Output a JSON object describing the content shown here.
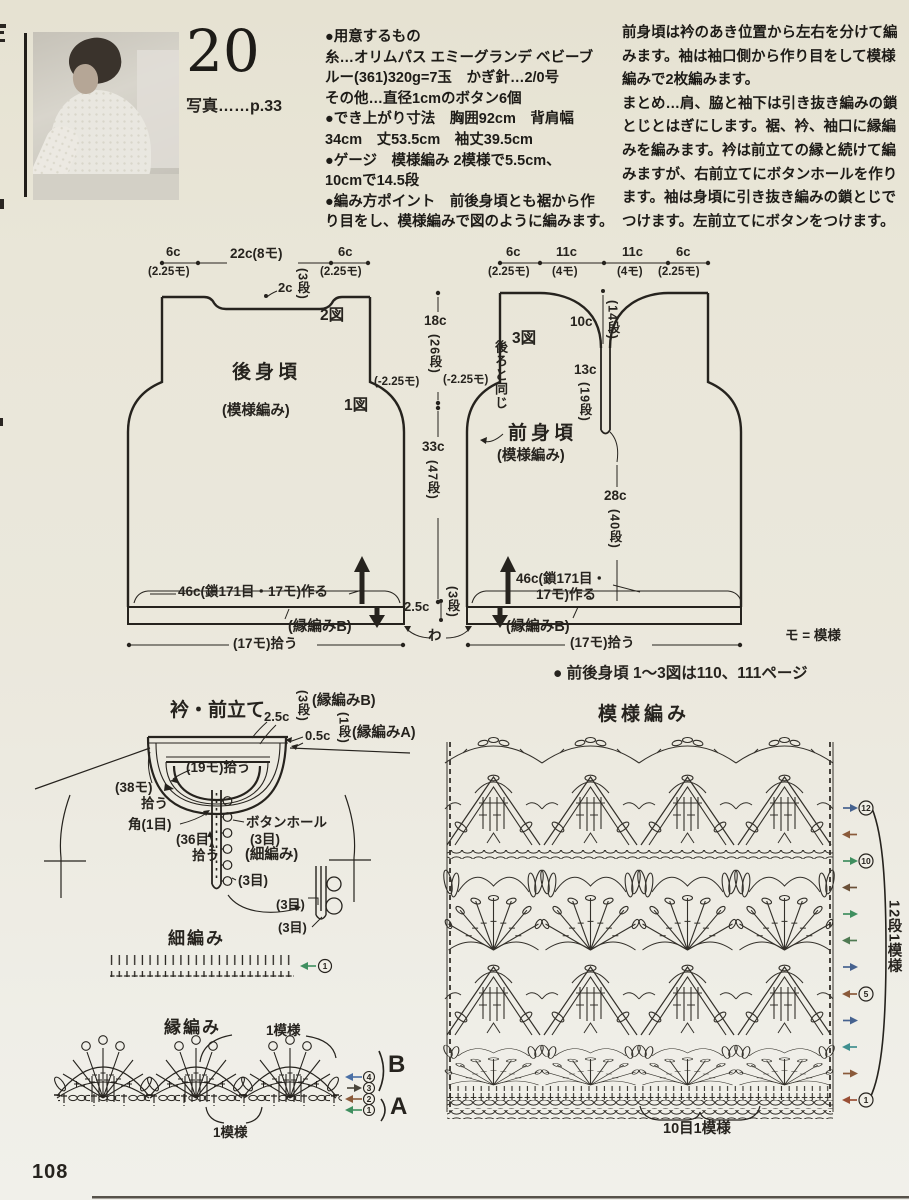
{
  "page": {
    "number": "108"
  },
  "photo": {
    "num": "20",
    "caption": "写真……p.33"
  },
  "materials": {
    "lines": [
      {
        "pre": "",
        "bold": "●用意するもの",
        "post": ""
      },
      {
        "pre": "",
        "bold": "糸",
        "post": "…オリムパス エミーグランデ ベビーブ"
      },
      {
        "pre": "ルー(361)320g=7玉　",
        "bold": "かぎ針",
        "post": "…2/0号"
      },
      {
        "pre": "",
        "bold": "その他",
        "post": "…直径1cmのボタン6個"
      },
      {
        "pre": "",
        "bold": "●でき上がり寸法",
        "post": "　胸囲92cm　背肩幅"
      },
      {
        "pre": "34cm　丈53.5cm　袖丈39.5cm",
        "bold": "",
        "post": ""
      },
      {
        "pre": "",
        "bold": "●ゲージ",
        "post": "　模様編み 2模様で5.5cm、"
      },
      {
        "pre": "10cmで14.5段",
        "bold": "",
        "post": ""
      },
      {
        "pre": "",
        "bold": "●編み方ポイント",
        "post": "　前後身頃とも裾から作"
      },
      {
        "pre": "り目をし、模様編みで図のように編みます。",
        "bold": "",
        "post": ""
      }
    ]
  },
  "howto": {
    "lines": [
      {
        "pre": "前身頃は衿のあき位置から左右を分けて編",
        "bold": "",
        "post": ""
      },
      {
        "pre": "みます。袖は袖口側から作り目をして模様",
        "bold": "",
        "post": ""
      },
      {
        "pre": "編みで2枚編みます。",
        "bold": "",
        "post": ""
      },
      {
        "pre": "",
        "bold": "まとめ",
        "post": "…肩、脇と袖下は引き抜き編みの鎖"
      },
      {
        "pre": "とじとはぎにします。裾、衿、袖口に縁編",
        "bold": "",
        "post": ""
      },
      {
        "pre": "みを編みます。衿は前立ての縁と続けて編",
        "bold": "",
        "post": ""
      },
      {
        "pre": "みますが、右前立てにボタンホールを作り",
        "bold": "",
        "post": ""
      },
      {
        "pre": "ます。袖は身頃に引き抜き編みの鎖とじで",
        "bold": "",
        "post": ""
      },
      {
        "pre": "つけます。左前立てにボタンをつけます。",
        "bold": "",
        "post": ""
      }
    ]
  },
  "sch": {
    "back": {
      "w1": "6c",
      "w1m": "(2.25モ)",
      "w2": "22c(8モ)",
      "w3": "6c",
      "w3m": "(2.25モ)",
      "neck": "2c",
      "neck_rows": "(3段)",
      "fig2": "2図",
      "name": "後身頃",
      "stitch": "(模様編み)",
      "fig1": "1図",
      "dec": "(-2.25モ)",
      "caston": "46c(鎖171目・17モ)作る",
      "edge": "(縁編みB)",
      "pickup": "(17モ)拾う"
    },
    "center": {
      "armhole": "18c",
      "armhole_rows": "(26段)",
      "side": "33c",
      "side_rows": "(47段)",
      "hem": "2.5c",
      "hem_rows": "(3段)",
      "wa": "わ"
    },
    "front": {
      "w1": "6c",
      "w1m": "(2.25モ)",
      "w2": "11c",
      "w2m": "(4モ)",
      "w3": "11c",
      "w3m": "(4モ)",
      "w4": "6c",
      "w4m": "(2.25モ)",
      "fig3": "3図",
      "same": "後ろと同じ",
      "dec": "(-2.25モ)",
      "neck": "10c",
      "neck_rows": "(14段)",
      "slit": "13c",
      "slit_rows": "(19段)",
      "name": "前身頃",
      "stitch": "(模様編み)",
      "body": "28c",
      "body_rows": "(40段)",
      "caston1": "46c(鎖171目・",
      "caston2": "17モ)作る",
      "edge": "(縁編みB)",
      "pickup": "(17モ)拾う"
    },
    "legend": "モ = 模様",
    "note": "● 前後身頃 1〜3図は110、111ページ"
  },
  "collar": {
    "title": "衿・前立て",
    "band_h": "2.5c",
    "band_rows": "(3段)",
    "band_label": "(縁編みB)",
    "edge_h": "0.5c",
    "edge_rows": "(1段)",
    "edge_label": "(縁編みA)",
    "pickup_neck": "(19モ)拾う",
    "pickup_side1": "(38モ)",
    "pickup_side2": "拾う",
    "corner": "角(1目)",
    "pickup_front1": "(36目)",
    "pickup_front2": "拾う",
    "buttonhole1": "ボタンホール",
    "buttonhole2": "(3目)",
    "sc_label": "(細編み)",
    "st3a": "(3目)",
    "st3b": "(3目)",
    "st3c": "(3目)"
  },
  "sc_chart": {
    "title": "細編み",
    "row": "1"
  },
  "edge_chart": {
    "title": "縁編み",
    "rep_top": "1模様",
    "rep_bottom": "1模様",
    "r4": "4",
    "r3": "3",
    "r2": "2",
    "r1": "1",
    "b": "B",
    "a": "A"
  },
  "pattern": {
    "title": "模様編み",
    "v_repeat": "12段1模様",
    "h_repeat": "10目1模様",
    "r12": "12",
    "r10": "10",
    "r5": "5",
    "r1": "1"
  }
}
